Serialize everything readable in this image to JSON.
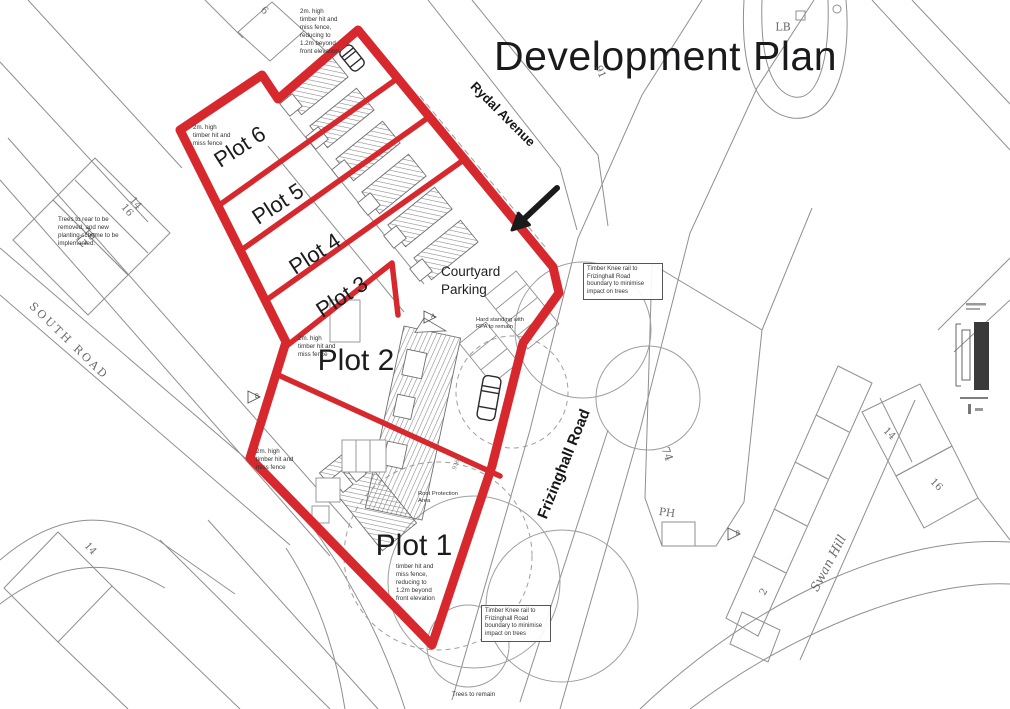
{
  "title": "Development Plan",
  "colors": {
    "boundary_red": "#d7282e",
    "arrow_black": "#1a1a1a",
    "map_line_grey": "#8f8f8f",
    "label_dark": "#1c1c1e",
    "map_text_grey": "#6a6a6a"
  },
  "plots": {
    "p1": "Plot 1",
    "p2": "Plot 2",
    "p3": "Plot 3",
    "p4": "Plot 4",
    "p5": "Plot 5",
    "p6": "Plot 6"
  },
  "streets": {
    "rydal_avenue": "Rydal Avenue",
    "frizinghall_road": "Frizinghall Road",
    "south_road": "SOUTH ROAD",
    "swan_hill": "Swan Hill"
  },
  "labels": {
    "courtyard_line1": "Courtyard",
    "courtyard_line2": "Parking"
  },
  "map_texts": {
    "lb": "LB",
    "house_6": "6",
    "house_91": "91",
    "left_14": "14",
    "left_16": "16",
    "left_10": "10",
    "left_12": "12",
    "house_74": "74",
    "ph": "PH",
    "right_14": "14",
    "right_16": "16",
    "house_2": "2",
    "bottom_14": "14",
    "marker_a": "A",
    "marker_b1": "B",
    "marker_b2": "B",
    "parcel_9362": "9362"
  },
  "annotations": {
    "fence_top": {
      "lines": [
        "2m. high",
        "timber hit and",
        "miss fence,",
        "reducing to",
        "1.2m beyond",
        "front elevation"
      ]
    },
    "fence_plot6": {
      "lines": [
        "2m. high",
        "timber hit and",
        "miss fence"
      ]
    },
    "trees_rear": {
      "lines": [
        "Trees to rear to be",
        "removed, and new",
        "planting scheme to be",
        "implemented."
      ]
    },
    "fence_plot2": {
      "lines": [
        "2m. high",
        "timber hit and",
        "miss fence"
      ]
    },
    "fence_plot2_lower": {
      "lines": [
        "2m. high",
        "timber hit and",
        "miss fence"
      ]
    },
    "hard_standing": {
      "lines": [
        "Hard standing with",
        "RPA to remain"
      ]
    },
    "knee_rail_upper": {
      "lines": [
        "Timber Knee rail to",
        "Frizinghall Road",
        "boundary to minimise",
        "impact on trees"
      ]
    },
    "knee_rail_lower": {
      "lines": [
        "Timber Knee rail to",
        "Frizinghall Road",
        "boundary to minimise",
        "impact on trees"
      ]
    },
    "fence_plot1": {
      "lines": [
        "timber hit and",
        "miss fence,",
        "reducing to",
        "1.2m beyond",
        "front elevation"
      ]
    },
    "root_protection": {
      "lines": [
        "Root Protection",
        "Area"
      ]
    },
    "trees_remain": {
      "lines": [
        "Trees to remain"
      ]
    }
  }
}
